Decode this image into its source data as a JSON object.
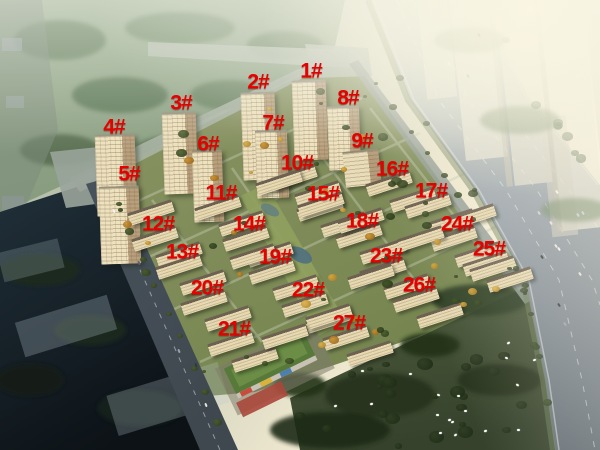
{
  "scene": {
    "type": "aerial-rendering-of-residential-development",
    "regions": [
      "park-greenbelt",
      "residential-estate",
      "highway",
      "bird-meadow",
      "kindergarten-building",
      "hazy-city-towers",
      "dark-avenue"
    ],
    "bird_flock_count": 18,
    "palette": {
      "label_red": "#e60000",
      "building_beige": "#e7d9b2",
      "building_shadow": "#b49c7a",
      "park_green": "#8fa688",
      "estate_green": "#7e8c57",
      "meadow_dark_green": "#46543a",
      "road_gray": "#9aa3ab",
      "haze_warm": "#f8f2de",
      "dark_corner": "#131c23"
    }
  },
  "label_style": {
    "color": "#e60000",
    "suffix": "#"
  },
  "building_labels": [
    {
      "text": "1#",
      "x": 311,
      "y": 71
    },
    {
      "text": "2#",
      "x": 258,
      "y": 82
    },
    {
      "text": "3#",
      "x": 181,
      "y": 103
    },
    {
      "text": "4#",
      "x": 114,
      "y": 127
    },
    {
      "text": "5#",
      "x": 129,
      "y": 174
    },
    {
      "text": "6#",
      "x": 208,
      "y": 144
    },
    {
      "text": "7#",
      "x": 273,
      "y": 123
    },
    {
      "text": "8#",
      "x": 348,
      "y": 98
    },
    {
      "text": "9#",
      "x": 362,
      "y": 141
    },
    {
      "text": "10#",
      "x": 297,
      "y": 163
    },
    {
      "text": "11#",
      "x": 221,
      "y": 193
    },
    {
      "text": "12#",
      "x": 158,
      "y": 224
    },
    {
      "text": "13#",
      "x": 182,
      "y": 252
    },
    {
      "text": "14#",
      "x": 249,
      "y": 224
    },
    {
      "text": "15#",
      "x": 323,
      "y": 194
    },
    {
      "text": "16#",
      "x": 392,
      "y": 169
    },
    {
      "text": "17#",
      "x": 431,
      "y": 191
    },
    {
      "text": "18#",
      "x": 362,
      "y": 221
    },
    {
      "text": "19#",
      "x": 275,
      "y": 257
    },
    {
      "text": "20#",
      "x": 207,
      "y": 288
    },
    {
      "text": "21#",
      "x": 234,
      "y": 329
    },
    {
      "text": "22#",
      "x": 308,
      "y": 290
    },
    {
      "text": "23#",
      "x": 386,
      "y": 256
    },
    {
      "text": "24#",
      "x": 457,
      "y": 224
    },
    {
      "text": "25#",
      "x": 489,
      "y": 249
    },
    {
      "text": "26#",
      "x": 419,
      "y": 285
    },
    {
      "text": "27#",
      "x": 349,
      "y": 323
    }
  ]
}
